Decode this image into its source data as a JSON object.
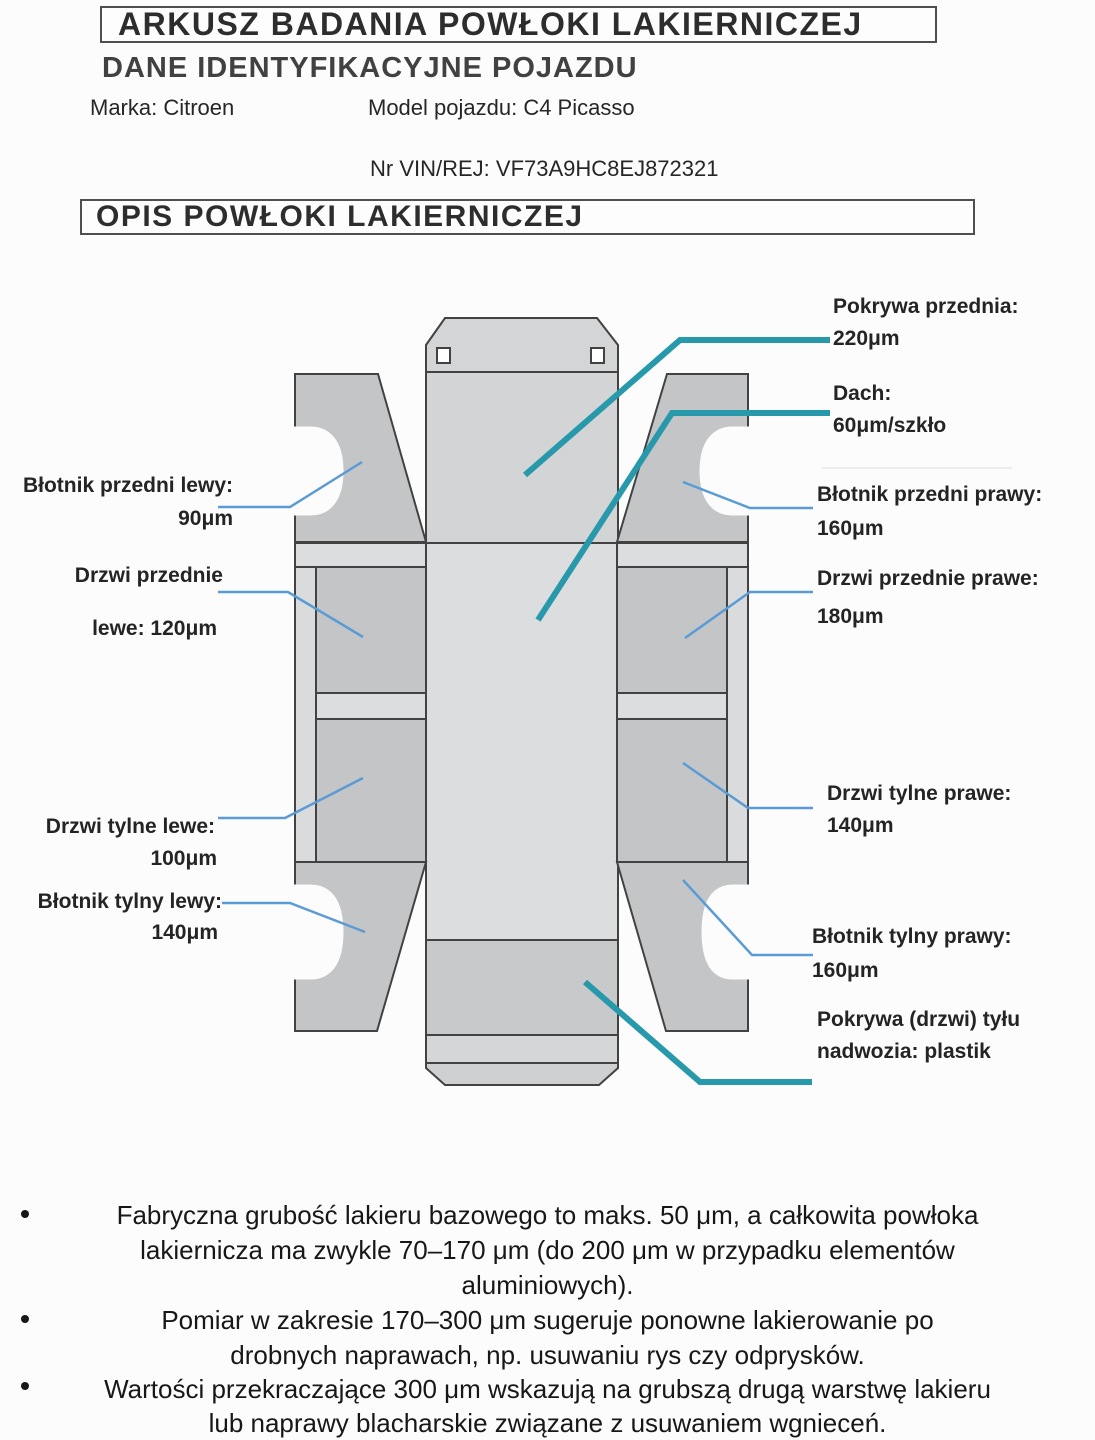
{
  "header": {
    "title": "ARKUSZ BADANIA POWŁOKI LAKIERNICZEJ",
    "vehicle_section": "DANE IDENTYFIKACYJNE POJAZDU",
    "brand": "Marka: Citroen",
    "model": "Model pojazdu: C4 Picasso",
    "vin": "Nr VIN/REJ: VF73A9HC8EJ872321",
    "coating_section": "OPIS POWŁOKI LAKIERNICZEJ"
  },
  "diagram": {
    "labels": {
      "pokrywa_przednia": {
        "title": "Pokrywa przednia:",
        "value": "220μm"
      },
      "dach": {
        "title": "Dach:",
        "value": "60μm/szkło"
      },
      "blotnik_przedni_lewy": {
        "title": "Błotnik przedni lewy:",
        "value": "90μm"
      },
      "blotnik_przedni_prawy": {
        "title": "Błotnik przedni prawy:",
        "value": "160μm"
      },
      "drzwi_przednie_lewe": {
        "title": "Drzwi przednie",
        "value": "lewe: 120μm"
      },
      "drzwi_przednie_prawe": {
        "title": "Drzwi przednie prawe:",
        "value": "180μm"
      },
      "drzwi_tylne_lewe": {
        "title": "Drzwi tylne lewe:",
        "value": "100μm"
      },
      "drzwi_tylne_prawe": {
        "title": "Drzwi tylne prawe:",
        "value": "140μm"
      },
      "blotnik_tylny_lewy": {
        "title": "Błotnik tylny lewy:",
        "value": "140μm"
      },
      "blotnik_tylny_prawy": {
        "title": "Błotnik tylny prawy:",
        "value": "160μm"
      },
      "pokrywa_tylu": {
        "title": "Pokrywa (drzwi) tyłu",
        "value": "nadwozia: plastik"
      }
    },
    "colors": {
      "pointer_teal": "#2898ab",
      "pointer_blue": "#5b9bd5",
      "panel": "#c3c5c7",
      "panel_light": "#dbdddf",
      "rocker": "#d9dbdc",
      "windshield": "#d2d4d5",
      "hood": "#d3d5d6",
      "rear_band": "#c7c9cb",
      "lower_band": "#d4d6d7",
      "trunk": "#ced0d2",
      "hinge": "#ffffff"
    }
  },
  "notes": {
    "items": [
      {
        "lines": [
          "Fabryczna grubość lakieru bazowego to maks. 50 μm, a całkowita powłoka",
          "lakiernicza ma zwykle 70–170 μm (do 200 μm w przypadku elementów",
          "aluminiowych)."
        ]
      },
      {
        "lines": [
          "Pomiar w zakresie 170–300 μm sugeruje ponowne lakierowanie po",
          "drobnych naprawach, np. usuwaniu rys czy odprysków."
        ]
      },
      {
        "lines": [
          "Wartości przekraczające 300 μm wskazują na grubszą drugą warstwę lakieru",
          "lub naprawy blacharskie związane z usuwaniem wgnieceń."
        ]
      },
      {
        "lines": [
          "Odczyty powyżej 500 μm mogą wskazywać na szpachlowanie i naprawy blacharskie."
        ]
      }
    ]
  }
}
